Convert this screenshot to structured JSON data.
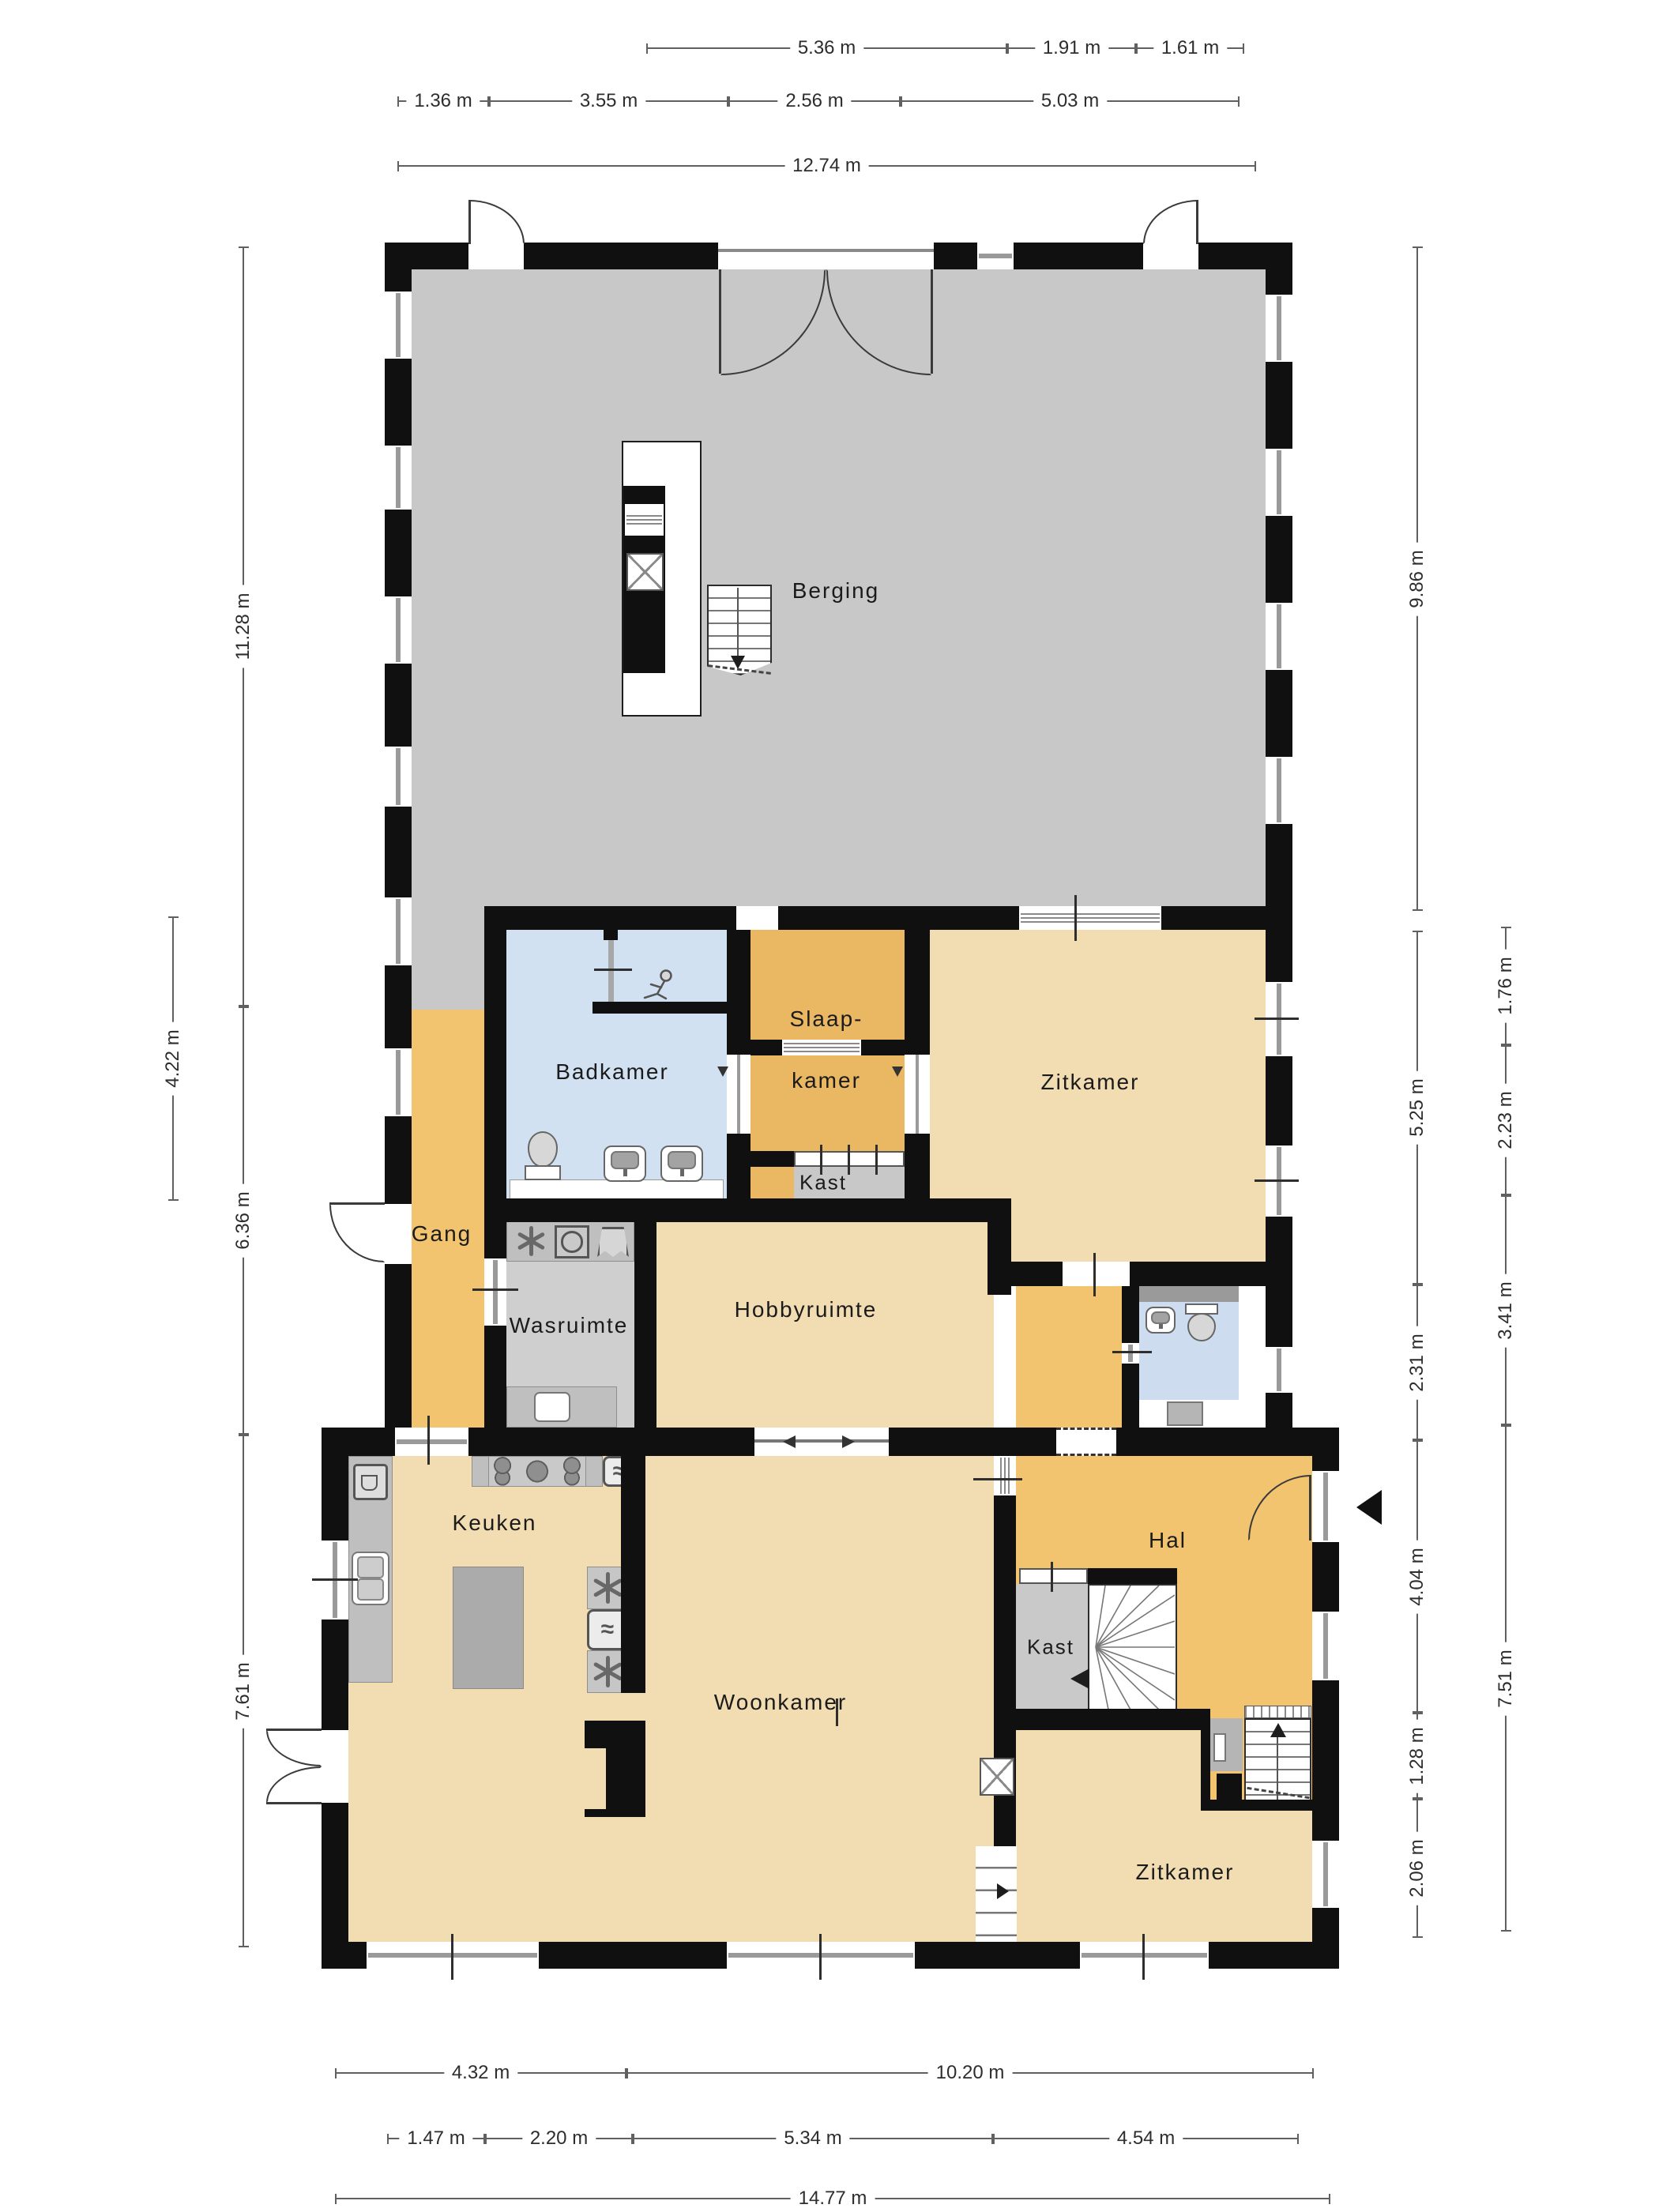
{
  "rooms": {
    "berging": "Berging",
    "badkamer": "Badkamer",
    "slaapkamer_l1": "Slaap-",
    "slaapkamer_l2": "kamer",
    "zitkamer_boven": "Zitkamer",
    "kast_boven": "Kast",
    "gang": "Gang",
    "wasruimte": "Wasruimte",
    "hobbyruimte": "Hobbyruimte",
    "keuken": "Keuken",
    "hal": "Hal",
    "kast_hal": "Kast",
    "woonkamer": "Woonkamer",
    "zitkamer_beneden": "Zitkamer"
  },
  "dimensions": {
    "top_row1": [
      "5.36 m",
      "1.91 m",
      "1.61 m"
    ],
    "top_row2": [
      "1.36 m",
      "3.55 m",
      "2.56 m",
      "5.03 m"
    ],
    "top_total": "12.74 m",
    "left_inner": [
      "11.28 m",
      "6.36 m",
      "7.61 m"
    ],
    "left_outer": [
      "4.22 m"
    ],
    "right_inner": [
      "9.86 m",
      "5.25 m",
      "2.31 m",
      "4.04 m",
      "1.28 m",
      "2.06 m"
    ],
    "right_outer": [
      "1.76 m",
      "2.23 m",
      "3.41 m",
      "7.51 m"
    ],
    "bottom_row1": [
      "4.32 m",
      "10.20 m"
    ],
    "bottom_row2": [
      "1.47 m",
      "2.20 m",
      "5.34 m",
      "4.54 m"
    ],
    "bottom_total": "14.77 m"
  },
  "icons": {
    "oven_glyph": "≈",
    "entry_arrow": "left-solid-triangle",
    "stairs_up_arrow": "up-triangle",
    "stairs_down_arrow": "down-triangle",
    "sliding_door_arrows": "left-right-triangles"
  },
  "colors": {
    "wall": "#101010",
    "floor_gray": "#c8c8c8",
    "floor_tan": "#f2ddb2",
    "floor_orange": "#f2c46f",
    "floor_orange_deep": "#eab863",
    "floor_blue": "#d2e1f1",
    "counter_gray": "#bfbfbf"
  }
}
